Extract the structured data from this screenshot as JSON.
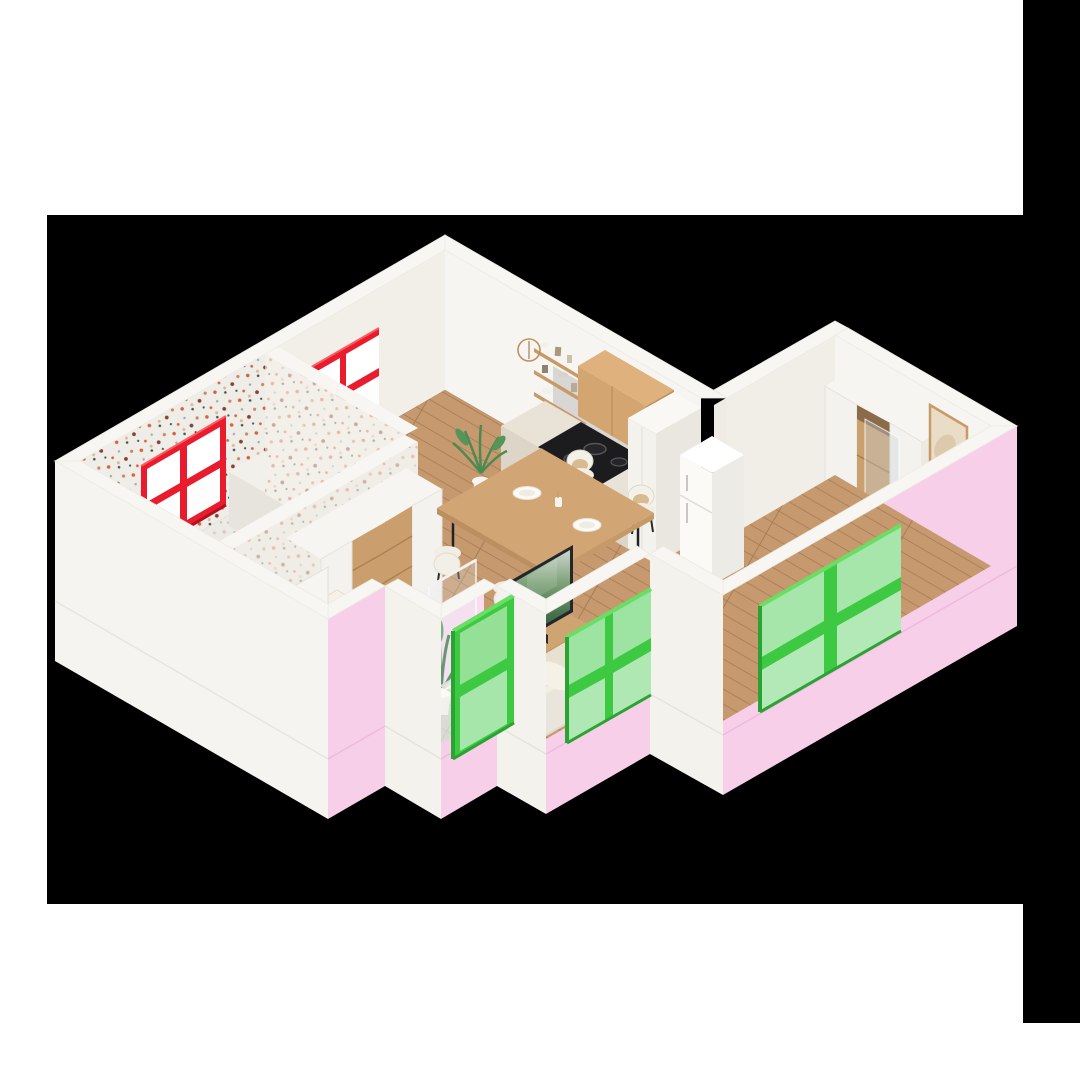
{
  "meta": {
    "kind": "3d-isometric-apartment-cutaway-render",
    "canvas": {
      "width": 1080,
      "height": 1080
    },
    "visible_text": ""
  },
  "background": {
    "page_color": "#ffffff",
    "matte_color": "#000000",
    "matte_main": {
      "x": 47,
      "y": 215,
      "w": 976,
      "h": 689
    },
    "matte_right_strip": {
      "x": 1023,
      "y": 0,
      "w": 57,
      "h": 1023
    }
  },
  "palette": {
    "wall_white": "#f2efe9",
    "wall_bright": "#f7f5f1",
    "wall_shade": "#e9e6e0",
    "exterior_pink": "#f7cfe9",
    "pink_seam": "#eebade",
    "window_green": "#3ec943",
    "window_green_dark": "#2ba332",
    "window_green_light": "#6ade64",
    "window_red": "#e81c2d",
    "window_red_dark": "#b2121f",
    "floor_wood": "#c69a6e",
    "floor_wood_line": "#ad805a",
    "cabinet_wood": "#d2a571",
    "cooktop_black": "#1c1c1f",
    "textile_cream": "#ece5d6",
    "terrazzo_base": "#efede8",
    "tile_gray": "#dcdad5"
  },
  "scene_inventory": {
    "windows": [
      {
        "name": "red-window-bath",
        "frame_color": "#e81c2d",
        "panes": 4,
        "wall": "back-left"
      },
      {
        "name": "red-window-dining",
        "frame_color": "#e81c2d",
        "panes": 4,
        "wall": "back-left"
      },
      {
        "name": "green-window-right",
        "frame_color": "#3ec943",
        "panes": 4,
        "wall": "front-right-pink"
      },
      {
        "name": "green-window-middle",
        "frame_color": "#3ec943",
        "panes": 4,
        "wall": "front-right-pink"
      },
      {
        "name": "green-window-front",
        "frame_color": "#3ec943",
        "panes": 2,
        "wall": "front-alcove-pink"
      }
    ],
    "rooms": [
      "kitchen-dining",
      "living",
      "bedroom",
      "bathroom-terrazzo",
      "hall",
      "window-alcove"
    ],
    "furniture": [
      "kitchen-counter-cooktop",
      "upper-wood-cabinet",
      "open-shelves",
      "tall-cabinet",
      "fridge",
      "dining-table",
      "dining-chairs-x4",
      "sofa",
      "tv-on-bench",
      "coffee-table",
      "rug",
      "dark-round-mat",
      "bed",
      "daybed",
      "nightstand-pampas",
      "wardrobe-open",
      "sliding-door-panel",
      "hall-closet",
      "framed-picture",
      "glass-partition",
      "bath-counter",
      "basket",
      "potted-palm",
      "alcove-plant"
    ]
  }
}
